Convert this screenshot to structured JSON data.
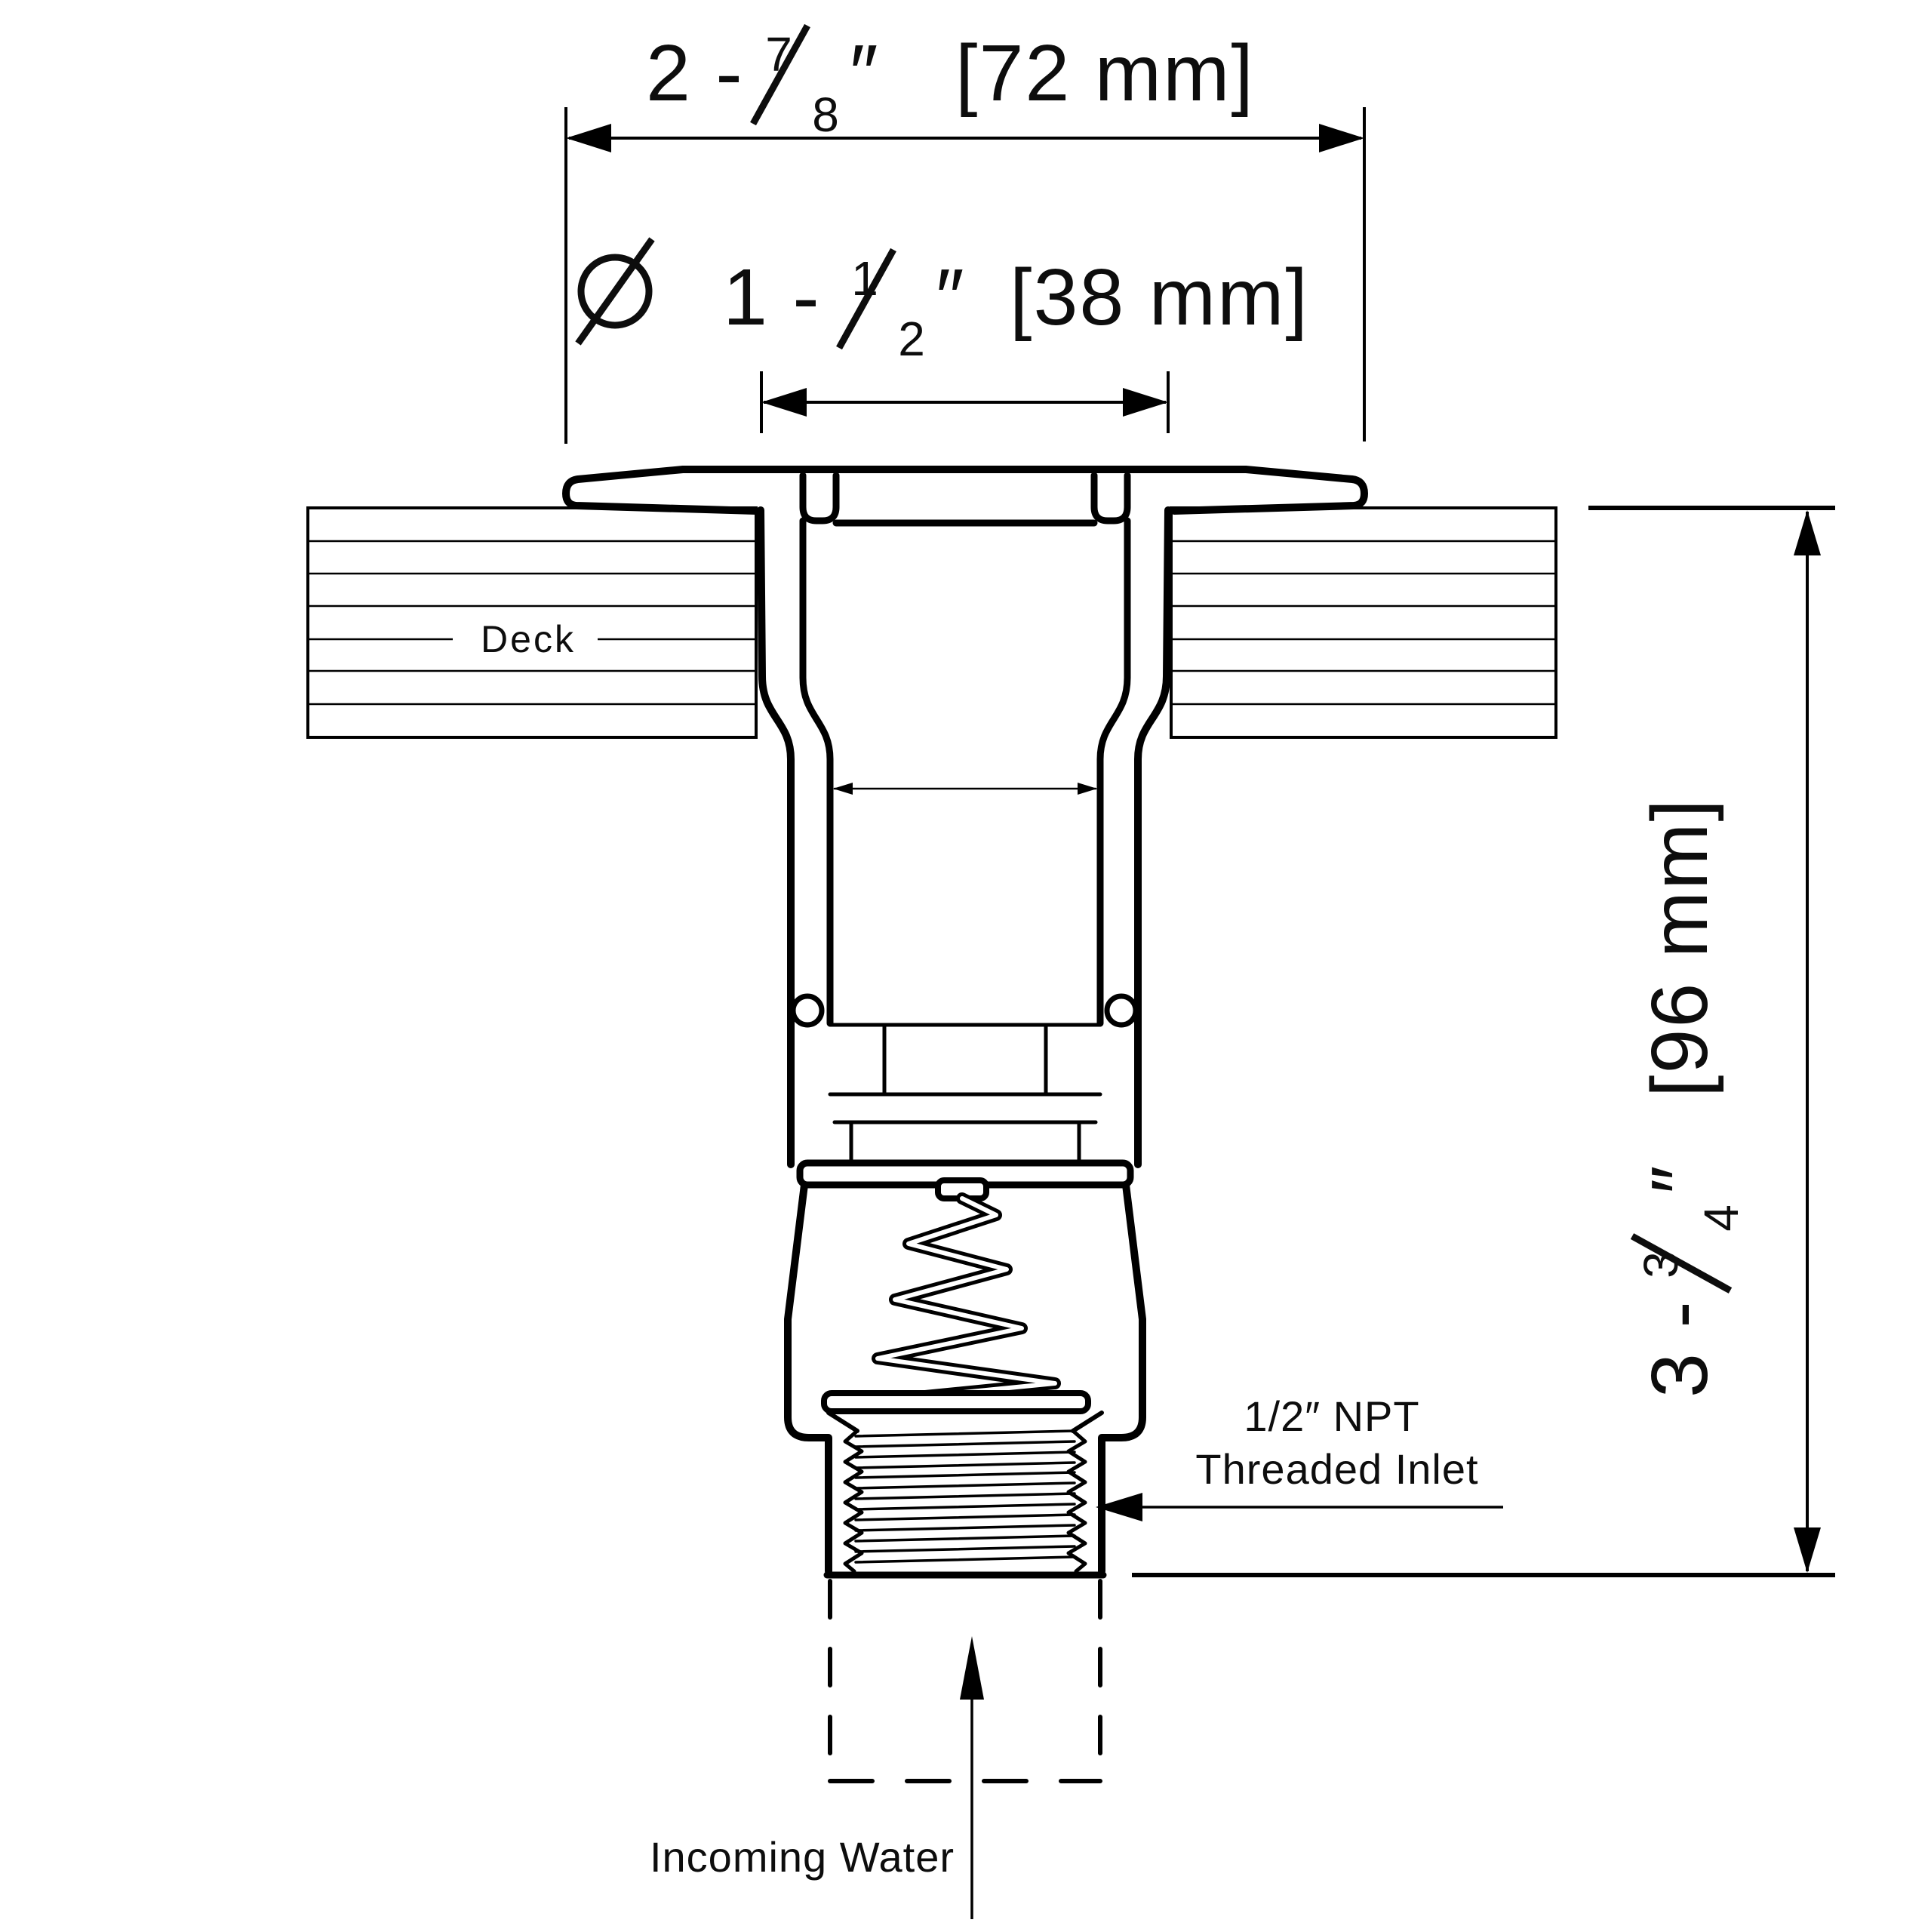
{
  "drawing": {
    "background": "#ffffff",
    "line_color": "#000000"
  },
  "dimensions": {
    "width": {
      "whole": "2 -",
      "numerator": "7",
      "denominator": "8",
      "unit": "″",
      "metric": "[72 mm]"
    },
    "diameter": {
      "symbol": "Ø",
      "whole": "1 -",
      "numerator": "1",
      "denominator": "2",
      "unit": "″",
      "metric": "[38 mm]"
    },
    "height": {
      "whole": "3 -",
      "numerator": "3",
      "denominator": "4",
      "unit": "″",
      "metric": "[96 mm]"
    }
  },
  "labels": {
    "deck": "Deck",
    "inlet_line1": "1/2″ NPT",
    "inlet_line2": "Threaded Inlet",
    "incoming_water": "Incoming Water"
  }
}
